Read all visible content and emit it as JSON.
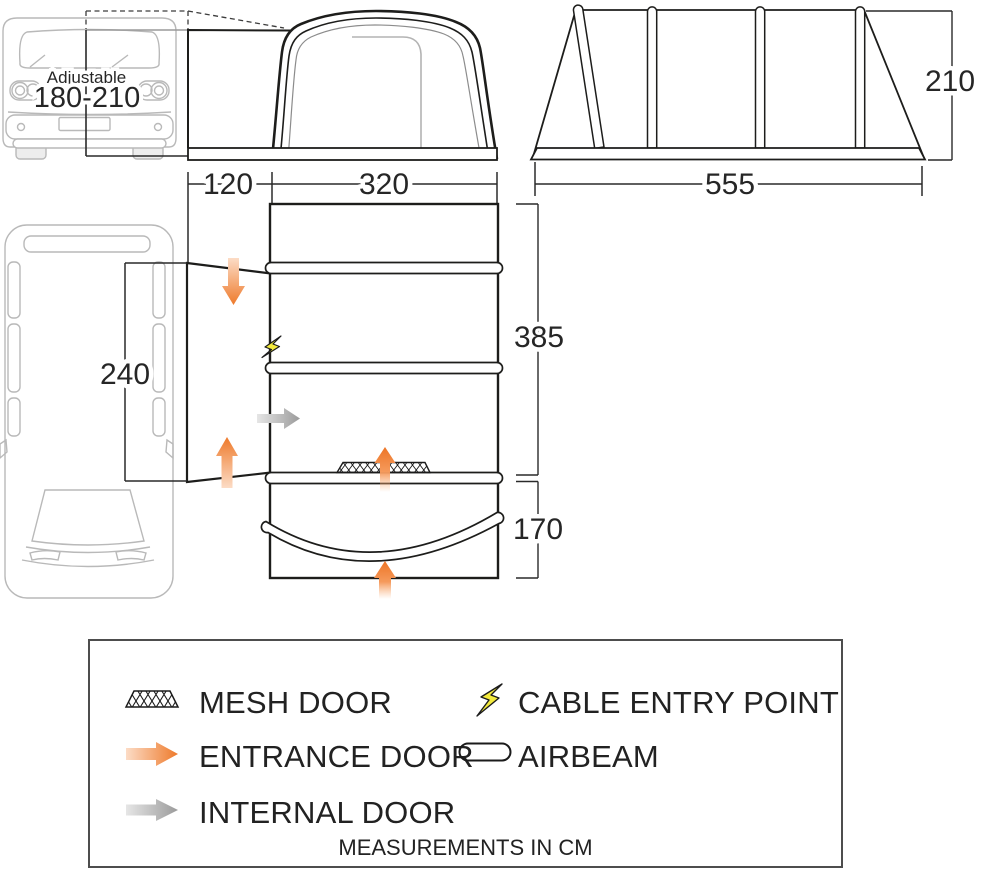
{
  "vehicle_note": {
    "line1": "Adjustable",
    "line2": "180-210"
  },
  "dimensions": {
    "tunnel_width": "120",
    "awning_front_width": "320",
    "side_length": "555",
    "rear_height": "210",
    "van_side_length": "240",
    "main_section_depth": "385",
    "front_section_depth": "170"
  },
  "legend": {
    "mesh_door": "MESH DOOR",
    "entrance_door": "ENTRANCE DOOR",
    "internal_door": "INTERNAL DOOR",
    "cable_entry": "CABLE ENTRY POINT",
    "airbeam": "AIRBEAM",
    "footnote": "MEASUREMENTS IN CM",
    "icons": [
      "mesh-door-icon",
      "entrance-door-arrow-icon",
      "internal-door-arrow-icon",
      "cable-entry-point-icon",
      "airbeam-icon"
    ]
  },
  "colors": {
    "outline": "#1d1d1b",
    "van_gray": "#b9b9b9",
    "dim_line": "#2a2a2a",
    "orange": "#ee7a2b",
    "orange_light": "#fcdcc6",
    "arrow_gray": "#9b9b9b",
    "arrow_gray_light": "#e6e6e6",
    "bolt_yellow": "#f3ea3d"
  }
}
